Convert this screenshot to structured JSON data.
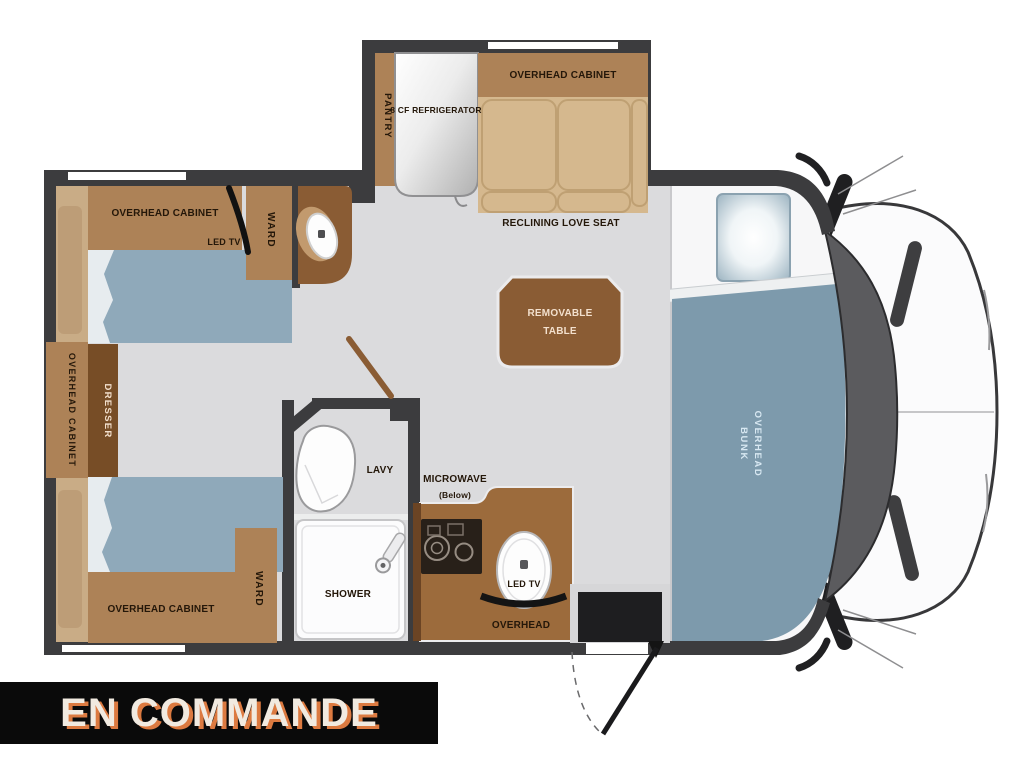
{
  "banner": {
    "text": "EN COMMANDE"
  },
  "labels": {
    "overhead_cabinet_top_left": "OVERHEAD CABINET",
    "led_tv_bedroom": "LED TV",
    "ward_top": "WARD",
    "pantry": "PANTRY",
    "refrigerator": "8 CF REFRIGERATOR",
    "overhead_cabinet_slide": "OVERHEAD CABINET",
    "reclining_love_seat": "RECLINING LOVE SEAT",
    "removable_table_line1": "REMOVABLE",
    "removable_table_line2": "TABLE",
    "overhead_cabinet_left": "OVERHEAD CABINET",
    "dresser": "DRESSER",
    "lavy": "LAVY",
    "microwave_line1": "MICROWAVE",
    "microwave_line2": "(Below)",
    "shower": "SHOWER",
    "led_tv_kitchen": "LED TV",
    "overhead_kitchen": "OVERHEAD",
    "overhead_cabinet_bottom": "OVERHEAD CABINET",
    "ward_bottom": "WARD",
    "overhead_bunk_line1": "OVERHEAD",
    "overhead_bunk_line2": "BUNK"
  },
  "colors": {
    "wall": "#3c3c3e",
    "floor": "#dbdbdd",
    "cab-floor": "#f7f7f8",
    "cabinet-light": "#ad8257",
    "cabinet-mid": "#9c6b3c",
    "cabinet-dark": "#8a5c34",
    "cabinet-deep": "#774d26",
    "headboard": "#c9ac86",
    "cushion": "#bd9d77",
    "seat": "#d5b88e",
    "seat-line": "#bfa073",
    "bed": "#8fa9ba",
    "bed-fold": "#e7ecef",
    "bunk": "#7d9aac",
    "label": "#241709",
    "label-light": "#f3e0cd",
    "bunk-label": "#d8e8f2",
    "cooktop": "#282019",
    "windshield": "#5b5b5e",
    "banner-bg": "#0a0a0a",
    "banner-text": "#f1eae0",
    "banner-shadow": "#dc7a40"
  }
}
